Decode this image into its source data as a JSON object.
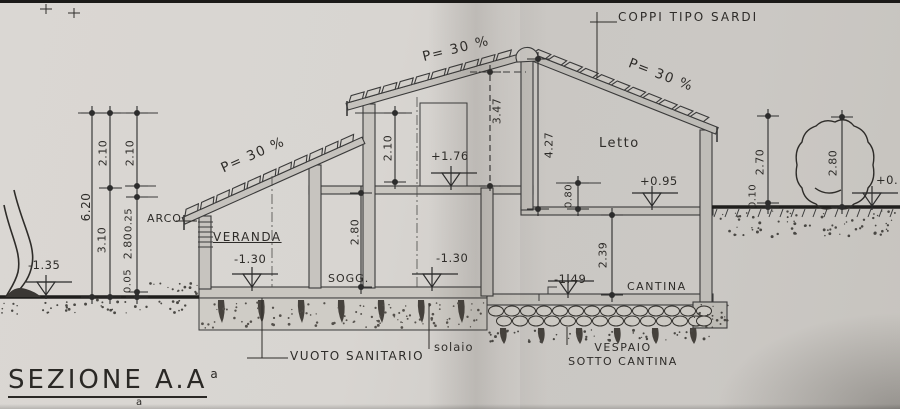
{
  "drawing": {
    "title": {
      "text": "SEZIONE A.A",
      "sup": "a",
      "sub": "a"
    },
    "colors": {
      "pencil": "#3a3a3a",
      "paper": "#d6d3cf"
    },
    "roof": {
      "tile_note": "COPPI TIPO SARDI",
      "pitch_veranda": "P= 30 %",
      "pitch_middle": "P= 30 %",
      "pitch_right": "P= 30 %"
    },
    "rooms": {
      "veranda": "VERANDA",
      "soggiorno": "SOGG.",
      "letto": "Letto",
      "cantina": "CANTINA"
    },
    "construction": {
      "arco": "ARCO",
      "vuoto_sanitario": "VUOTO SANITARIO",
      "solaio": "solaio",
      "vespaio_line1": "VESPAIO",
      "vespaio_line2": "SOTTO CANTINA"
    },
    "levels": {
      "terrain_left": "-1.35",
      "veranda_floor": "-1.30",
      "sogg_floor": "-1.30",
      "first_floor": "+1.76",
      "letto_floor": "+0.95",
      "cantina_floor": "-1.49",
      "terrain_right": "+0."
    },
    "dimensions": {
      "left_total": "6.20",
      "left_upper_a": "2.10",
      "left_lower_a": "3.10",
      "left_upper_b": "2.10",
      "left_beam": "0.25",
      "left_room": "2.80",
      "left_plinth": "0.05",
      "mid_wall": "2.10",
      "sogg_room": "2.80",
      "ridge_upper": "3.47",
      "letto_room": "4.27",
      "floor_step": "0.80",
      "cantina_room": "2.39",
      "right_a": "2.70",
      "right_a2": "0.10",
      "right_b": "2.80"
    }
  }
}
